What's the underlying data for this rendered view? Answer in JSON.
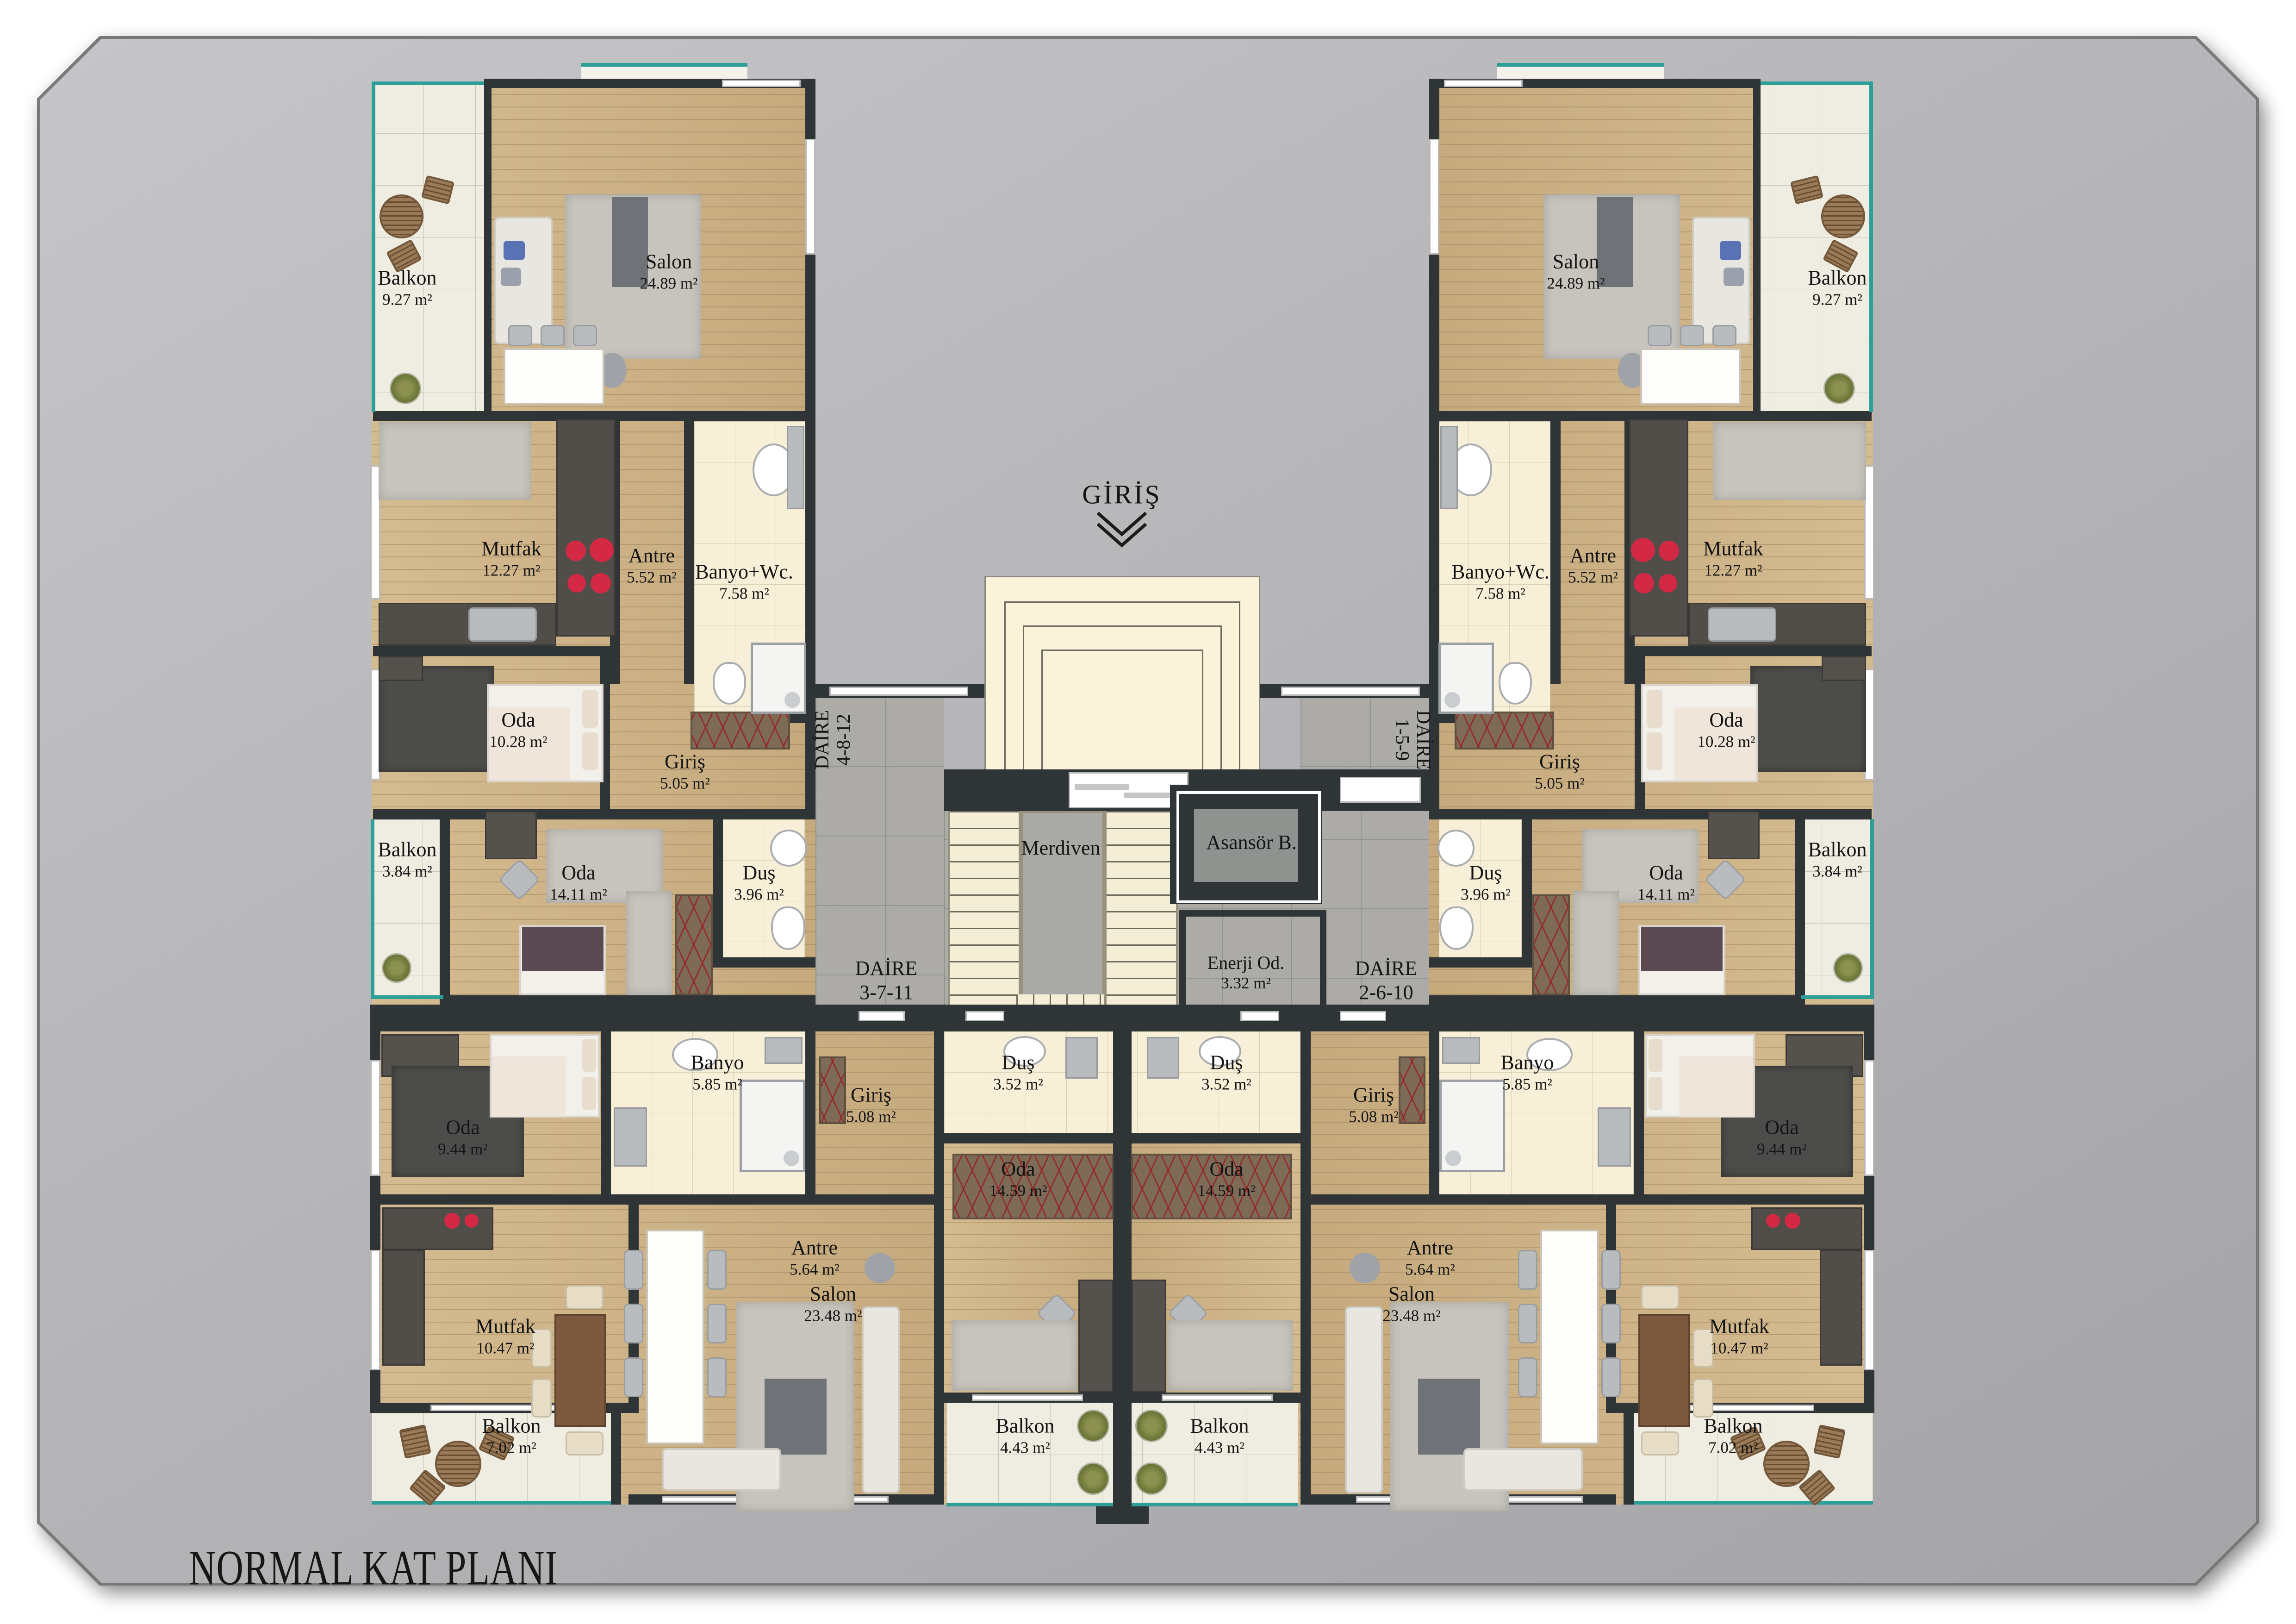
{
  "title": "NORMAL KAT PLANI",
  "entrance": {
    "label": "GİRİŞ"
  },
  "core": {
    "merdiven": "Merdiven",
    "asansor": "Asansör B.",
    "enerji": {
      "name": "Enerji Od.",
      "area": "3.32 m²"
    },
    "daire_top_left": {
      "name": "DAİRE",
      "no": "4-8-12"
    },
    "daire_top_right": {
      "name": "DAİRE",
      "no": "1-5-9"
    },
    "daire_bottom_left": {
      "name": "DAİRE",
      "no": "3-7-11"
    },
    "daire_bottom_right": {
      "name": "DAİRE",
      "no": "2-6-10"
    }
  },
  "rooms": {
    "balkon_wing": {
      "name": "Balkon",
      "area": "9.27 m²"
    },
    "salon_wing": {
      "name": "Salon",
      "area": "24.89 m²"
    },
    "mutfak_wing": {
      "name": "Mutfak",
      "area": "12.27 m²"
    },
    "antre_wing": {
      "name": "Antre",
      "area": "5.52 m²"
    },
    "banyo_wc_wing": {
      "name": "Banyo+Wc.",
      "area": "7.58 m²"
    },
    "oda_wing": {
      "name": "Oda",
      "area": "10.28 m²"
    },
    "giris_wing": {
      "name": "Giriş",
      "area": "5.05 m²"
    },
    "balkon_mid": {
      "name": "Balkon",
      "area": "3.84 m²"
    },
    "oda_mid": {
      "name": "Oda",
      "area": "14.11 m²"
    },
    "dus_mid": {
      "name": "Duş",
      "area": "3.96 m²"
    },
    "oda_small": {
      "name": "Oda",
      "area": "9.44 m²"
    },
    "banyo": {
      "name": "Banyo",
      "area": "5.85 m²"
    },
    "giris_lower": {
      "name": "Giriş",
      "area": "5.08 m²"
    },
    "antre_lower": {
      "name": "Antre",
      "area": "5.64 m²"
    },
    "mutfak_lower": {
      "name": "Mutfak",
      "area": "10.47 m²"
    },
    "salon_lower": {
      "name": "Salon",
      "area": "23.48 m²"
    },
    "balkon_lower": {
      "name": "Balkon",
      "area": "7.02 m²"
    },
    "dus_center": {
      "name": "Duş",
      "area": "3.52 m²"
    },
    "oda_center": {
      "name": "Oda",
      "area": "14.59 m²"
    },
    "balkon_center": {
      "name": "Balkon",
      "area": "4.43 m²"
    }
  },
  "colors": {
    "accent_teal": "#2d9f98",
    "wall": "#2f3437",
    "wood": "#d0b384",
    "tile_cream": "#f8efd8",
    "balcony_tile": "#efece1",
    "lobby_gray": "#acaba7",
    "stove_red": "#d32945"
  }
}
